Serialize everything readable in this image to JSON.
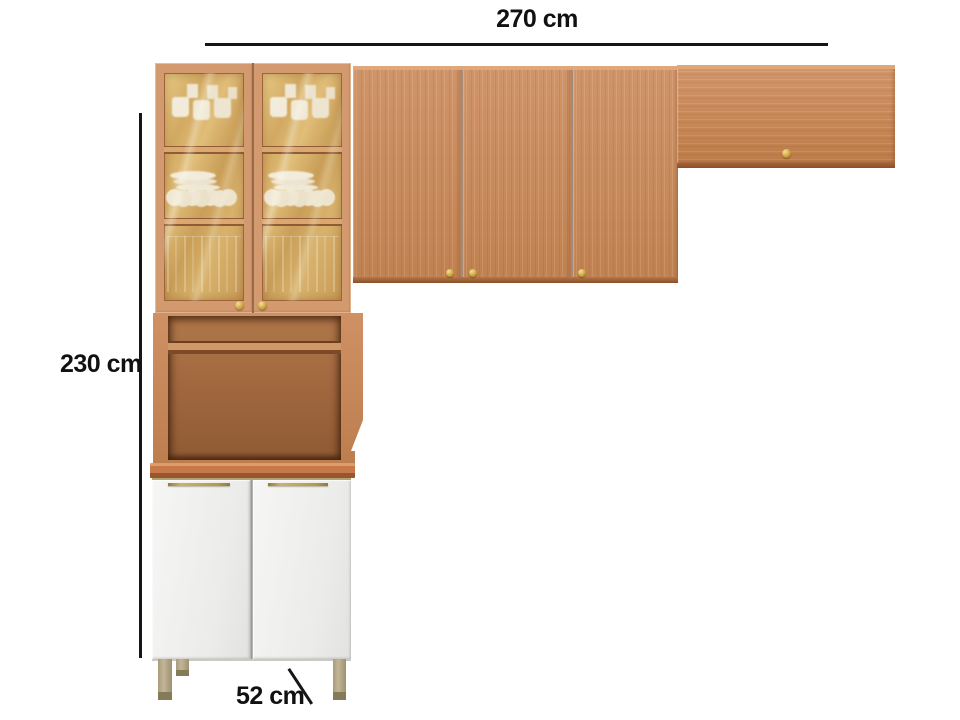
{
  "diagram": {
    "subject": "kitchen cabinet set",
    "dimensions": {
      "width_label": "270 cm",
      "height_label": "230 cm",
      "depth_label": "52 cm"
    }
  },
  "colors": {
    "wood": "#c98d60",
    "wood_dark": "#9a5c30",
    "cabinet_interior": "#a26940",
    "glass_tint": "#d6ae68",
    "base_door_white": "#f1f1ef",
    "handle_brass": "#b2a270",
    "knob_gold": "#cda43f",
    "leg_metal": "#b3a685",
    "dimension_line": "#161616",
    "background": "#ffffff"
  }
}
